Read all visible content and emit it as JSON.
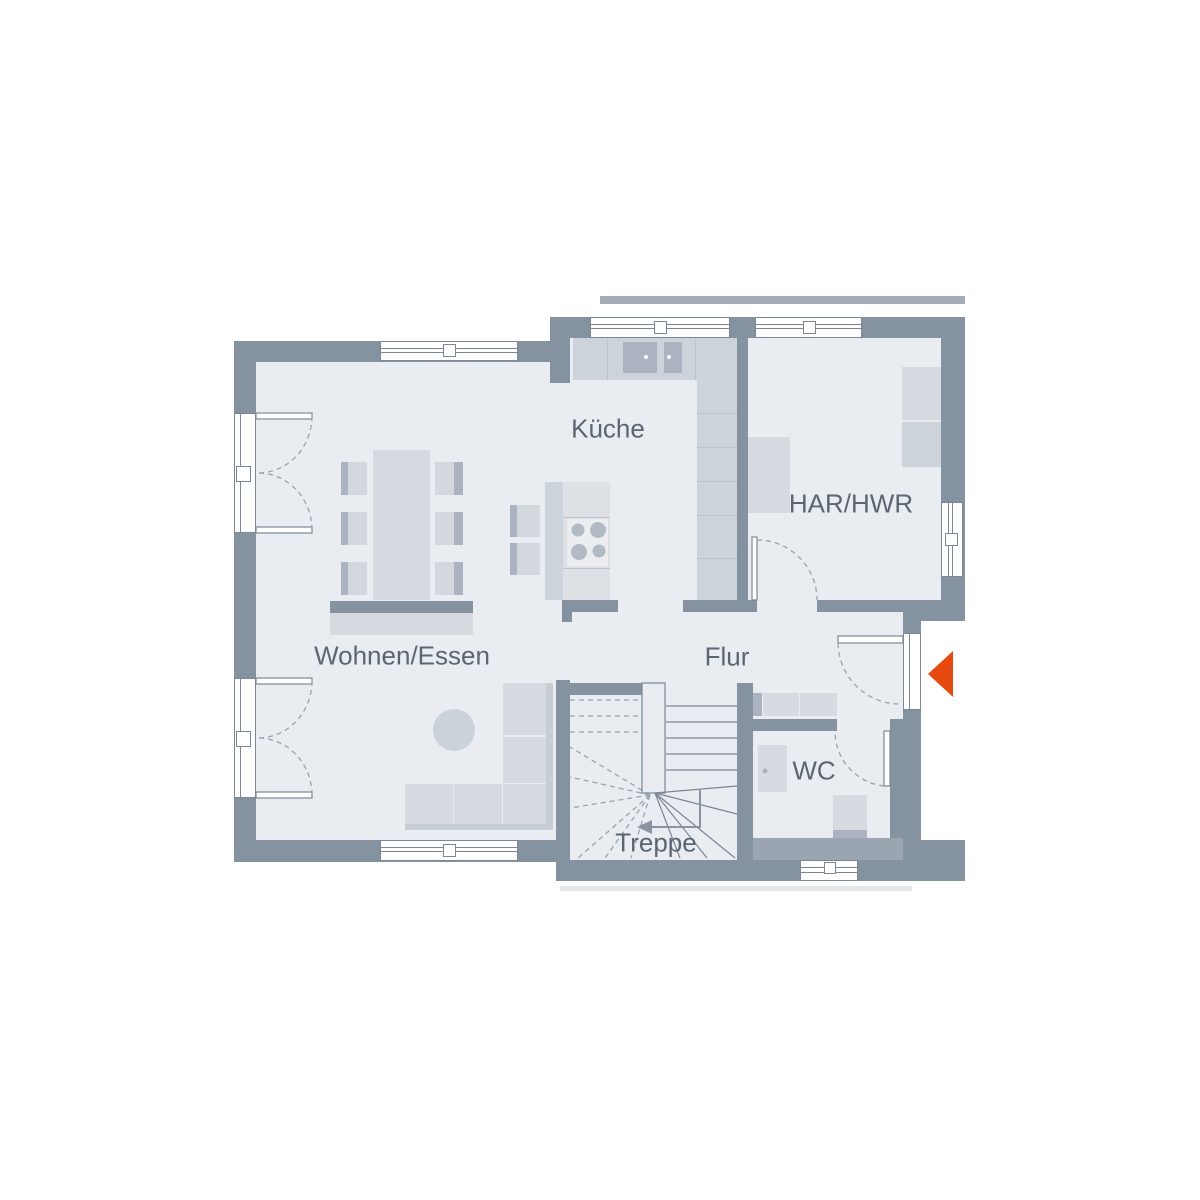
{
  "plan": {
    "labels": {
      "kitchen": "Küche",
      "utility_room": "HAR/HWR",
      "living_dining": "Wohnen/Essen",
      "hallway": "Flur",
      "wc": "WC",
      "stairs": "Treppe"
    },
    "colors": {
      "wall": "#8592a0",
      "wall_medium": "#9aa5b1",
      "floor": "#e9ecf1",
      "furniture_light": "#d7dbe1",
      "furniture_mid": "#cdd3da",
      "furniture_dark": "#aab3bf",
      "outline": "#7b8795",
      "swing_dash": "#99a3ae",
      "entrance_accent": "#e64a0f",
      "label_text": "#5c6672"
    },
    "icons": {
      "entrance_arrow": "entrance-direction-arrow",
      "stairs_direction_arrow": "stairs-down-direction-arrow"
    }
  }
}
